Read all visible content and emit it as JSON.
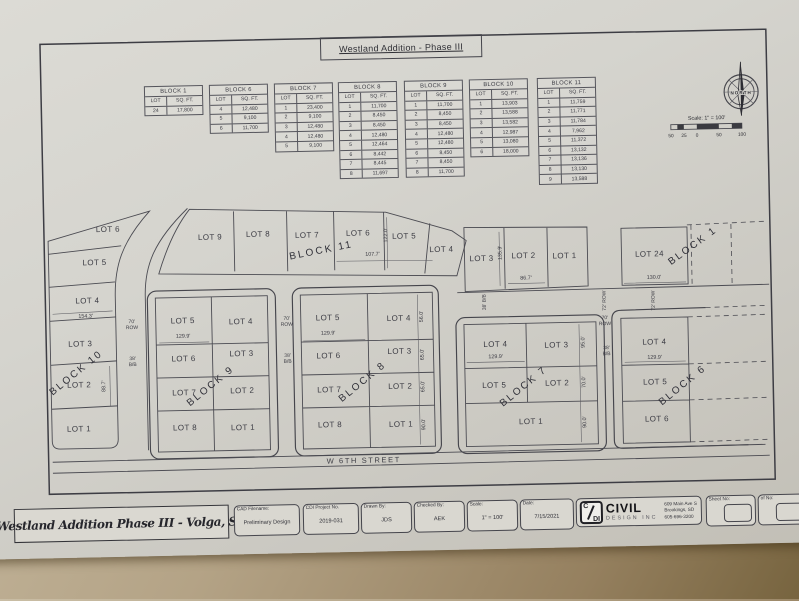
{
  "sheet_title": "Westland Addition - Phase III",
  "compass": {
    "label": "NORTH"
  },
  "scale_bar": {
    "label": "Scale: 1\" = 100'",
    "ticks": [
      "50",
      "25",
      "0",
      "50",
      "100"
    ]
  },
  "table_headers": {
    "lot": "LOT",
    "sqft": "SQ. FT."
  },
  "tables": [
    {
      "block": "BLOCK 1",
      "rows": [
        [
          "24",
          "17,800"
        ]
      ]
    },
    {
      "block": "BLOCK 6",
      "rows": [
        [
          "4",
          "12,480"
        ],
        [
          "5",
          "9,100"
        ],
        [
          "6",
          "11,700"
        ]
      ]
    },
    {
      "block": "BLOCK 7",
      "rows": [
        [
          "1",
          "23,400"
        ],
        [
          "2",
          "9,100"
        ],
        [
          "3",
          "12,480"
        ],
        [
          "4",
          "12,480"
        ],
        [
          "5",
          "9,100"
        ]
      ]
    },
    {
      "block": "BLOCK 8",
      "rows": [
        [
          "1",
          "11,700"
        ],
        [
          "2",
          "8,450"
        ],
        [
          "3",
          "8,450"
        ],
        [
          "4",
          "12,480"
        ],
        [
          "5",
          "12,464"
        ],
        [
          "6",
          "8,442"
        ],
        [
          "7",
          "8,445"
        ],
        [
          "8",
          "11,697"
        ]
      ]
    },
    {
      "block": "BLOCK 9",
      "rows": [
        [
          "1",
          "11,700"
        ],
        [
          "2",
          "8,450"
        ],
        [
          "3",
          "8,450"
        ],
        [
          "4",
          "12,480"
        ],
        [
          "5",
          "12,480"
        ],
        [
          "6",
          "8,450"
        ],
        [
          "7",
          "8,450"
        ],
        [
          "8",
          "11,700"
        ]
      ]
    },
    {
      "block": "BLOCK 10",
      "rows": [
        [
          "1",
          "13,903"
        ],
        [
          "2",
          "13,588"
        ],
        [
          "3",
          "13,582"
        ],
        [
          "4",
          "12,987"
        ],
        [
          "5",
          "13,080"
        ],
        [
          "6",
          "18,000"
        ]
      ]
    },
    {
      "block": "BLOCK 11",
      "rows": [
        [
          "1",
          "11,759"
        ],
        [
          "2",
          "11,771"
        ],
        [
          "3",
          "11,784"
        ],
        [
          "4",
          "7,962"
        ],
        [
          "5",
          "11,372"
        ],
        [
          "6",
          "13,132"
        ],
        [
          "7",
          "13,136"
        ],
        [
          "8",
          "13,130"
        ],
        [
          "9",
          "13,588"
        ]
      ]
    }
  ],
  "map": {
    "labels": [
      {
        "t": "LOT 6",
        "x": 104,
        "y": 231
      },
      {
        "t": "LOT 5",
        "x": 90,
        "y": 264
      },
      {
        "t": "LOT 4",
        "x": 82,
        "y": 302
      },
      {
        "t": "154.3'",
        "x": 80,
        "y": 318,
        "s": "dim"
      },
      {
        "t": "LOT 3",
        "x": 74,
        "y": 345
      },
      {
        "t": "BLOCK 10",
        "x": 70,
        "y": 374,
        "r": -38,
        "s": "block"
      },
      {
        "t": "LOT 2",
        "x": 72,
        "y": 386
      },
      {
        "t": "88.7'",
        "x": 98,
        "y": 387,
        "r": -90,
        "s": "dim"
      },
      {
        "t": "LOT 1",
        "x": 71,
        "y": 430
      },
      {
        "t": "70'\nROW",
        "x": 126,
        "y": 327,
        "s": "road"
      },
      {
        "t": "38'\nB/B",
        "x": 126,
        "y": 364,
        "s": "road"
      },
      {
        "t": "LOT 5",
        "x": 177,
        "y": 324
      },
      {
        "t": "LOT 4",
        "x": 235,
        "y": 326
      },
      {
        "t": "129.9'",
        "x": 177,
        "y": 340,
        "s": "dim"
      },
      {
        "t": "LOT 6",
        "x": 177,
        "y": 362
      },
      {
        "t": "LOT 3",
        "x": 235,
        "y": 358
      },
      {
        "t": "LOT 7",
        "x": 177,
        "y": 396
      },
      {
        "t": "LOT 2",
        "x": 235,
        "y": 395
      },
      {
        "t": "BLOCK 9",
        "x": 204,
        "y": 390,
        "r": -38,
        "s": "block"
      },
      {
        "t": "LOT 8",
        "x": 177,
        "y": 431
      },
      {
        "t": "LOT 1",
        "x": 235,
        "y": 432
      },
      {
        "t": "70'\nROW",
        "x": 281,
        "y": 327,
        "s": "road"
      },
      {
        "t": "38'\nB/B",
        "x": 281,
        "y": 364,
        "s": "road"
      },
      {
        "t": "LOT 5",
        "x": 322,
        "y": 324
      },
      {
        "t": "LOT 4",
        "x": 393,
        "y": 326
      },
      {
        "t": "129.9'",
        "x": 322,
        "y": 340,
        "s": "dim"
      },
      {
        "t": "LOT 6",
        "x": 322,
        "y": 362
      },
      {
        "t": "LOT 3",
        "x": 393,
        "y": 359
      },
      {
        "t": "LOT 7",
        "x": 322,
        "y": 396
      },
      {
        "t": "LOT 2",
        "x": 393,
        "y": 394
      },
      {
        "t": "BLOCK 8",
        "x": 356,
        "y": 389,
        "r": -38,
        "s": "block"
      },
      {
        "t": "LOT 8",
        "x": 322,
        "y": 431
      },
      {
        "t": "LOT 1",
        "x": 393,
        "y": 432
      },
      {
        "t": "56.0'",
        "x": 417,
        "y": 324,
        "r": -90,
        "s": "dim"
      },
      {
        "t": "65.0'",
        "x": 417,
        "y": 362,
        "r": -90,
        "s": "dim"
      },
      {
        "t": "65.0'",
        "x": 417,
        "y": 394,
        "r": -90,
        "s": "dim"
      },
      {
        "t": "90.0'",
        "x": 417,
        "y": 432,
        "r": -90,
        "s": "dim"
      },
      {
        "t": "W 6TH STREET",
        "x": 355,
        "y": 467,
        "s": "street"
      },
      {
        "t": "LOT 9",
        "x": 206,
        "y": 241
      },
      {
        "t": "LOT 8",
        "x": 254,
        "y": 239
      },
      {
        "t": "LOT 7",
        "x": 303,
        "y": 241
      },
      {
        "t": "BLOCK 11",
        "x": 317,
        "y": 257,
        "r": -10,
        "s": "block"
      },
      {
        "t": "LOT 6",
        "x": 354,
        "y": 240
      },
      {
        "t": "107.7'",
        "x": 368,
        "y": 262,
        "s": "dim"
      },
      {
        "t": "122.0'",
        "x": 383,
        "y": 242,
        "r": -90,
        "s": "dim"
      },
      {
        "t": "LOT 5",
        "x": 400,
        "y": 244
      },
      {
        "t": "LOT 4",
        "x": 437,
        "y": 258
      },
      {
        "t": "LOT 3",
        "x": 477,
        "y": 268
      },
      {
        "t": "135.9'",
        "x": 497,
        "y": 262,
        "r": -90,
        "s": "dim"
      },
      {
        "t": "LOT 2",
        "x": 519,
        "y": 266
      },
      {
        "t": "86.7'",
        "x": 521,
        "y": 289,
        "s": "dim"
      },
      {
        "t": "LOT 1",
        "x": 560,
        "y": 267
      },
      {
        "t": "LOT 24",
        "x": 645,
        "y": 267
      },
      {
        "t": "130.0'",
        "x": 649,
        "y": 291,
        "s": "dim"
      },
      {
        "t": "BLOCK 1",
        "x": 689,
        "y": 260,
        "r": -35,
        "s": "block"
      },
      {
        "t": "38' B/B",
        "x": 480,
        "y": 311,
        "r": -90,
        "s": "road"
      },
      {
        "t": "72' ROW",
        "x": 600,
        "y": 312,
        "r": -90,
        "s": "road"
      },
      {
        "t": "72' ROW",
        "x": 649,
        "y": 313,
        "r": -90,
        "s": "road"
      },
      {
        "t": "LOT 4",
        "x": 489,
        "y": 354
      },
      {
        "t": "129.9'",
        "x": 489,
        "y": 367,
        "s": "dim"
      },
      {
        "t": "LOT 3",
        "x": 550,
        "y": 356
      },
      {
        "t": "95.0'",
        "x": 578,
        "y": 353,
        "r": -90,
        "s": "dim"
      },
      {
        "t": "LOT 5",
        "x": 487,
        "y": 395
      },
      {
        "t": "LOT 2",
        "x": 550,
        "y": 394
      },
      {
        "t": "70.0'",
        "x": 578,
        "y": 393,
        "r": -90,
        "s": "dim"
      },
      {
        "t": "BLOCK 7",
        "x": 517,
        "y": 397,
        "r": -38,
        "s": "block"
      },
      {
        "t": "LOT 1",
        "x": 523,
        "y": 432
      },
      {
        "t": "90.0'",
        "x": 578,
        "y": 433,
        "r": -90,
        "s": "dim"
      },
      {
        "t": "70'\nROW",
        "x": 599,
        "y": 333,
        "s": "road"
      },
      {
        "t": "38'\nB/B",
        "x": 600,
        "y": 363,
        "s": "road"
      },
      {
        "t": "LOT 4",
        "x": 648,
        "y": 355
      },
      {
        "t": "129.9'",
        "x": 648,
        "y": 371,
        "s": "dim"
      },
      {
        "t": "LOT 5",
        "x": 648,
        "y": 395
      },
      {
        "t": "BLOCK 6",
        "x": 676,
        "y": 399,
        "r": -38,
        "s": "block"
      },
      {
        "t": "LOT 6",
        "x": 649,
        "y": 432
      }
    ]
  },
  "titleblock": {
    "project": "Westland Addition Phase III - Volga, SD",
    "cells": [
      {
        "label": "CAD Filename:",
        "value": "Preliminary Design"
      },
      {
        "label": "CDI Project No.",
        "value": "2019-031"
      },
      {
        "label": "Drawn By:",
        "value": "JDS"
      },
      {
        "label": "Checked By:",
        "value": "AEK"
      },
      {
        "label": "Scale:",
        "value": "1\" = 100'"
      },
      {
        "label": "Date:",
        "value": "7/15/2021"
      }
    ],
    "company": {
      "logo_top": "C",
      "logo_bottom": "DI",
      "name": "CIVIL",
      "subname": "DESIGN INC",
      "address": [
        "609 Main Ave S",
        "Brookings, SD",
        "605-696-3200"
      ]
    },
    "sheet_no_label": "Sheet No:",
    "of_no_label": "of No:"
  }
}
